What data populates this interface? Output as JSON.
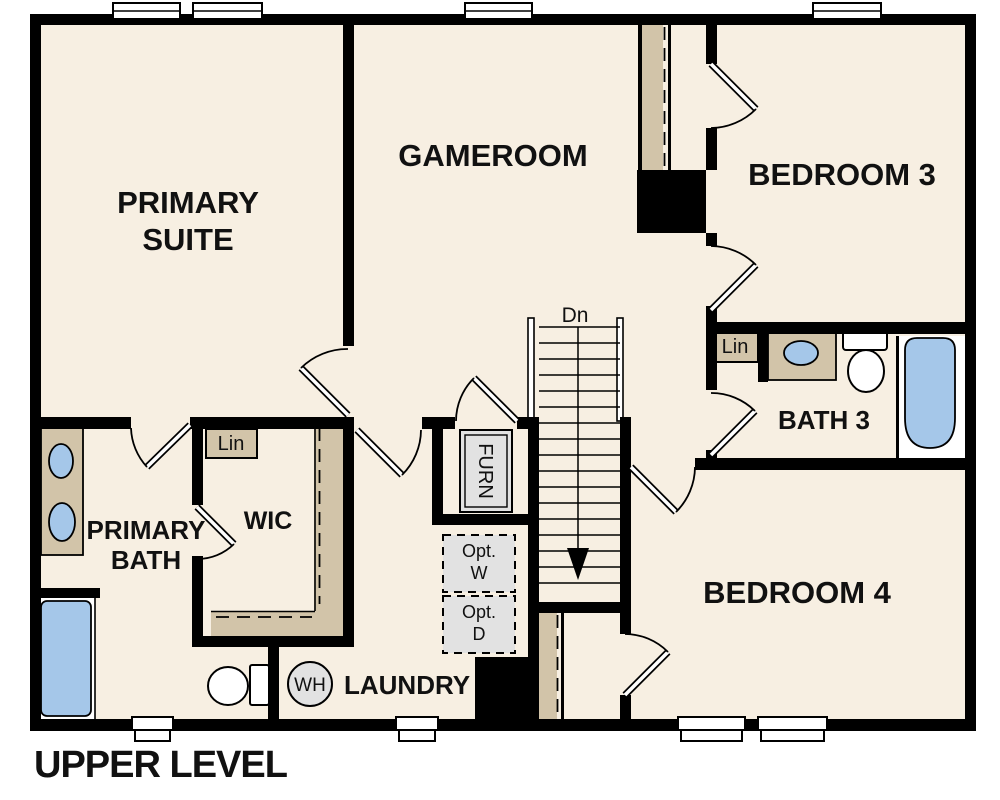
{
  "title": "UPPER LEVEL",
  "colors": {
    "floor": "#f7efe2",
    "wall": "#000000",
    "casework": "#d2c4a9",
    "fixture_blue": "#a5c7e9",
    "equipment_gray": "#e2e2e2",
    "label": "#111111"
  },
  "rooms": {
    "primary_suite": {
      "line1": "PRIMARY",
      "line2": "SUITE"
    },
    "gameroom": {
      "label": "GAMEROOM"
    },
    "bedroom3": {
      "label": "BEDROOM 3"
    },
    "bedroom4": {
      "label": "BEDROOM 4"
    },
    "bath3": {
      "label": "BATH 3"
    },
    "primary_bath": {
      "line1": "PRIMARY",
      "line2": "BATH"
    },
    "wic": {
      "label": "WIC"
    },
    "laundry": {
      "label": "LAUNDRY"
    }
  },
  "features": {
    "stairs_direction": "Dn",
    "linen_wic": "Lin",
    "linen_bath3": "Lin",
    "furnace": "FURN",
    "water_heater": "WH",
    "opt_washer": {
      "line1": "Opt.",
      "line2": "W"
    },
    "opt_dryer": {
      "line1": "Opt.",
      "line2": "D"
    }
  }
}
